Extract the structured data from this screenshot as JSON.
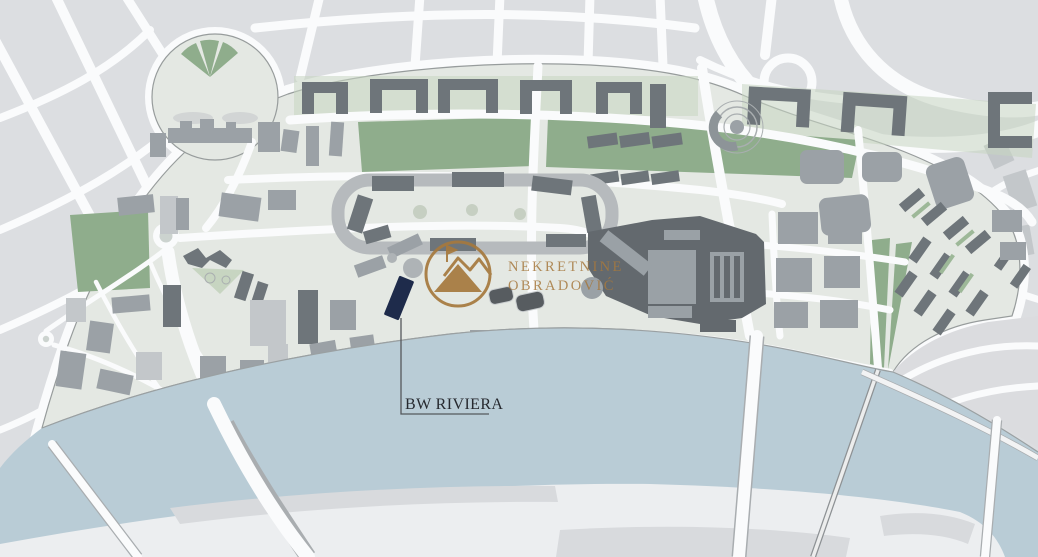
{
  "map": {
    "marker": {
      "label": "BW RIVIERA"
    },
    "watermark": {
      "line1": "NEKRETNINE",
      "line2": "OBRADOVIĆ",
      "icon": "mountain-peaks-logo-icon"
    },
    "colors": {
      "outer_block": "#dcdee1",
      "street": "#fafbfc",
      "dev_bg": "#e4e8e3",
      "dev_outline": "#979c9c",
      "park_green": "#8fad8c",
      "park_light": "#c7d5c1",
      "green_strip": "#9db898",
      "building_light": "#c3c7ca",
      "building_medium": "#9ba1a6",
      "building_dark": "#6e757a",
      "building_darkest": "#575c60",
      "complex_dark": "#63696e",
      "complex_inner": "#9aa1a6",
      "river": "#b9ccd6",
      "far_bank": "#eceef0",
      "far_bank_block": "#d8dadd",
      "plaza_gray": "#dbdcdf",
      "highlight_navy": "#1e2b4b",
      "leader_line": "#55585c",
      "label_text": "#26292f",
      "logo_bronze": "#a6793e",
      "outline_thin": "#a9aeb0"
    }
  }
}
